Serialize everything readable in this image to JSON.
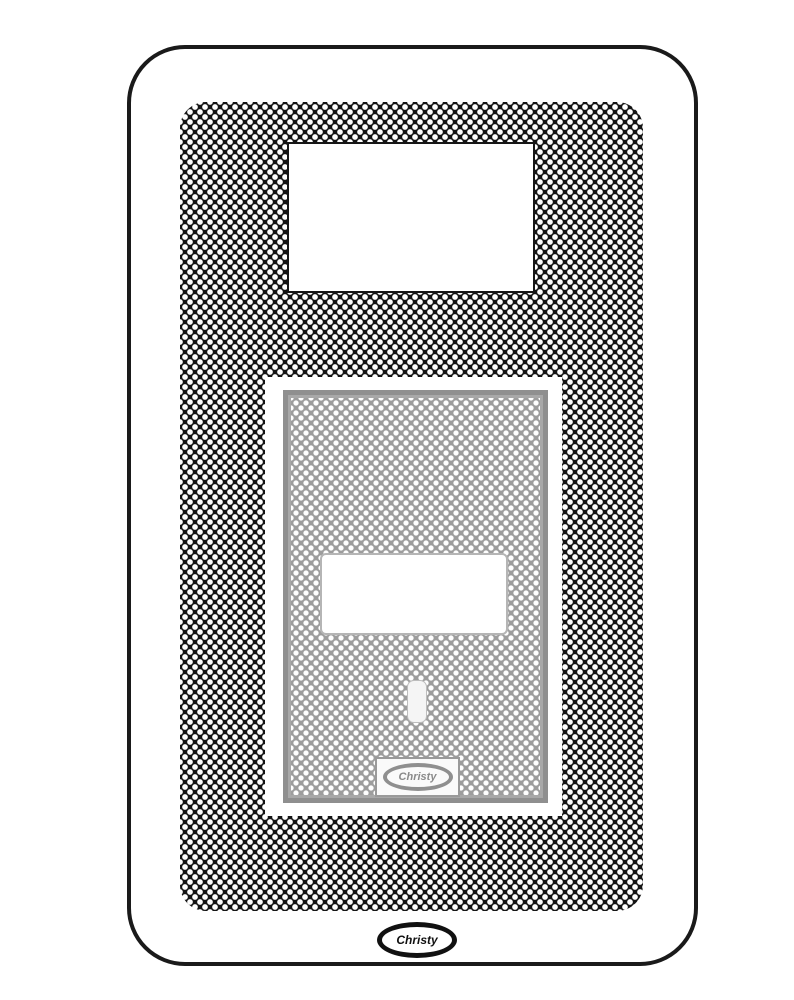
{
  "diagram": {
    "size_label": "12",
    "lid_logo": {
      "text": "Christy"
    },
    "brand_logo": {
      "text": "Christy"
    },
    "colors": {
      "outline_black": "#1a1a1a",
      "texture_black": "#141414",
      "lid_gray": "#9d9d9d",
      "lid_border_gray": "#8f8f8f",
      "white": "#ffffff"
    }
  }
}
